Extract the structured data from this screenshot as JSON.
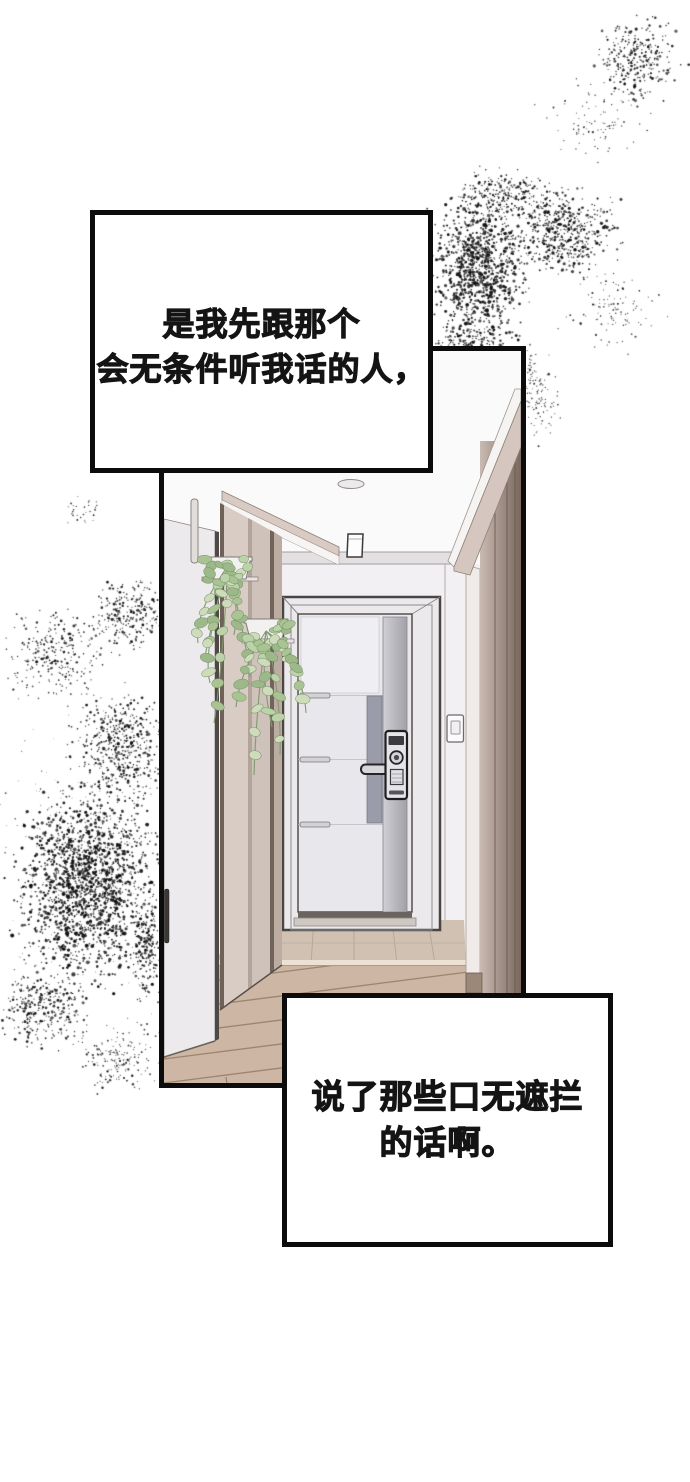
{
  "speech_boxes": {
    "top": {
      "line1": "是我先跟那个",
      "line2": "会无条件听我话的人，"
    },
    "bottom": {
      "line1": "说了那些口无遮拦",
      "line2": "的话啊。"
    }
  }
}
